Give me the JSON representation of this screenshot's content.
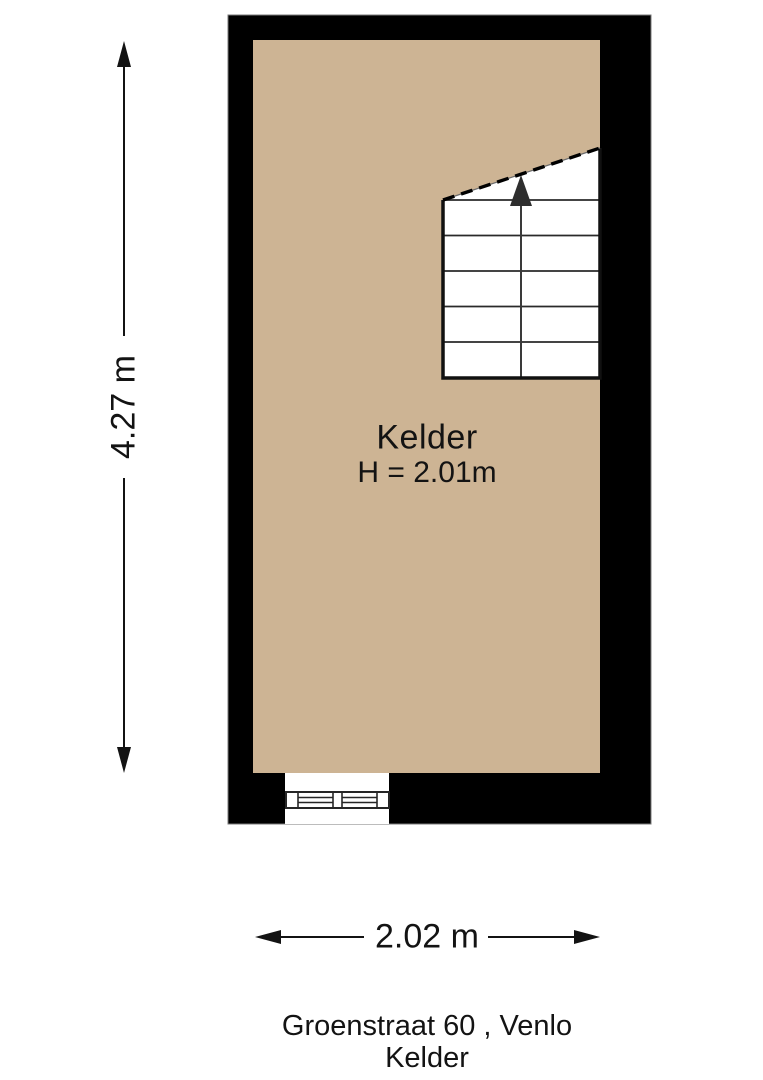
{
  "page": {
    "type": "floorplan-diagram"
  },
  "colors": {
    "background": "#ffffff",
    "wall": "#000000",
    "floor": "#cdb494",
    "stairs": "#ffffff",
    "line": "#111111"
  },
  "room": {
    "name": "Kelder",
    "height_label": "H = 2.01m"
  },
  "dimensions": {
    "vertical_label": "4.27 m",
    "horizontal_label": "2.02 m"
  },
  "footer": {
    "address_line": "Groenstraat 60 , Venlo",
    "floor_line": "Kelder"
  },
  "icons": {
    "stairs_up_arrow": "triangle-up",
    "dimension_arrows": "filled-triangle"
  }
}
